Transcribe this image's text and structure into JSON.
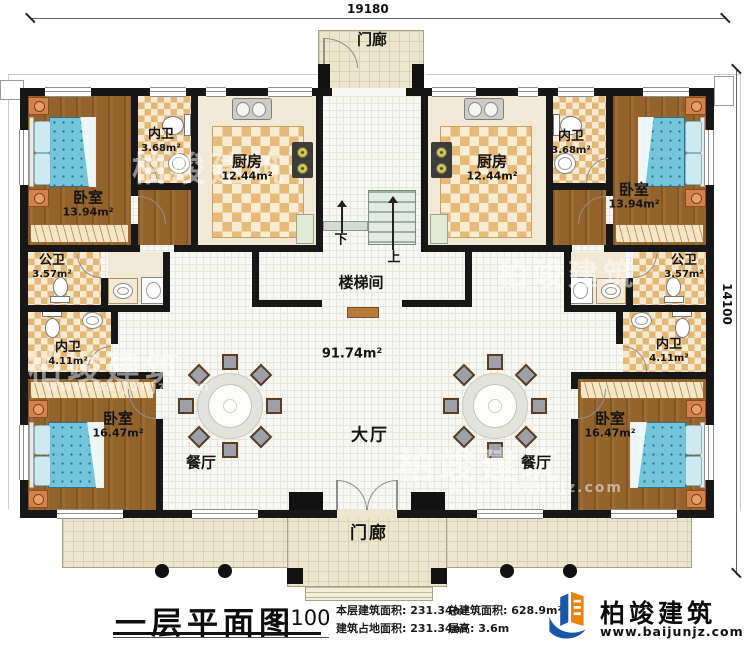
{
  "dims": {
    "top": "19180",
    "right": "14100"
  },
  "rooms": {
    "porch_top": {
      "name": "门廊"
    },
    "porch_bottom": {
      "name": "门廊"
    },
    "bedroom_tl": {
      "name": "卧室",
      "area": "13.94m²"
    },
    "neiwei_tl": {
      "name": "内卫",
      "area": "3.68m²"
    },
    "kitchen_l": {
      "name": "厨房",
      "area": "12.44m²"
    },
    "kitchen_r": {
      "name": "厨房",
      "area": "12.44m²"
    },
    "neiwei_tr": {
      "name": "内卫",
      "area": "3.68m²"
    },
    "bedroom_tr": {
      "name": "卧室",
      "area": "13.94m²"
    },
    "gongwei_l": {
      "name": "公卫",
      "area": "3.57m²"
    },
    "gongwei_r": {
      "name": "公卫",
      "area": "3.57m²"
    },
    "neiwei_bl": {
      "name": "内卫",
      "area": "4.11m²"
    },
    "neiwei_br": {
      "name": "内卫",
      "area": "4.11m²"
    },
    "bedroom_bl": {
      "name": "卧室",
      "area": "16.47m²"
    },
    "bedroom_br": {
      "name": "卧室",
      "area": "16.47m²"
    },
    "stair_hall": {
      "name": "楼梯间"
    },
    "hall": {
      "name": "大厅",
      "area": "91.74m²"
    },
    "dining_l": {
      "name": "餐厅"
    },
    "dining_r": {
      "name": "餐厅"
    }
  },
  "stairs": {
    "down": "下",
    "up": "上"
  },
  "titleblock": {
    "title": "一层平面图",
    "scale": "1:100",
    "stats": {
      "floor": {
        "label": "本层建筑面积:",
        "value": "231.34m²"
      },
      "total": {
        "label": "总建筑面积:",
        "value": "628.9m²"
      },
      "footprint": {
        "label": "建筑占地面积:",
        "value": "231.34m²"
      },
      "height": {
        "label": "层高:",
        "value": "3.6m"
      }
    }
  },
  "logo": {
    "name": "柏竣建筑",
    "url": "www.baijunjz.com"
  },
  "watermark": {
    "text": "柏竣建筑",
    "url": "www.baijunjz.com"
  }
}
